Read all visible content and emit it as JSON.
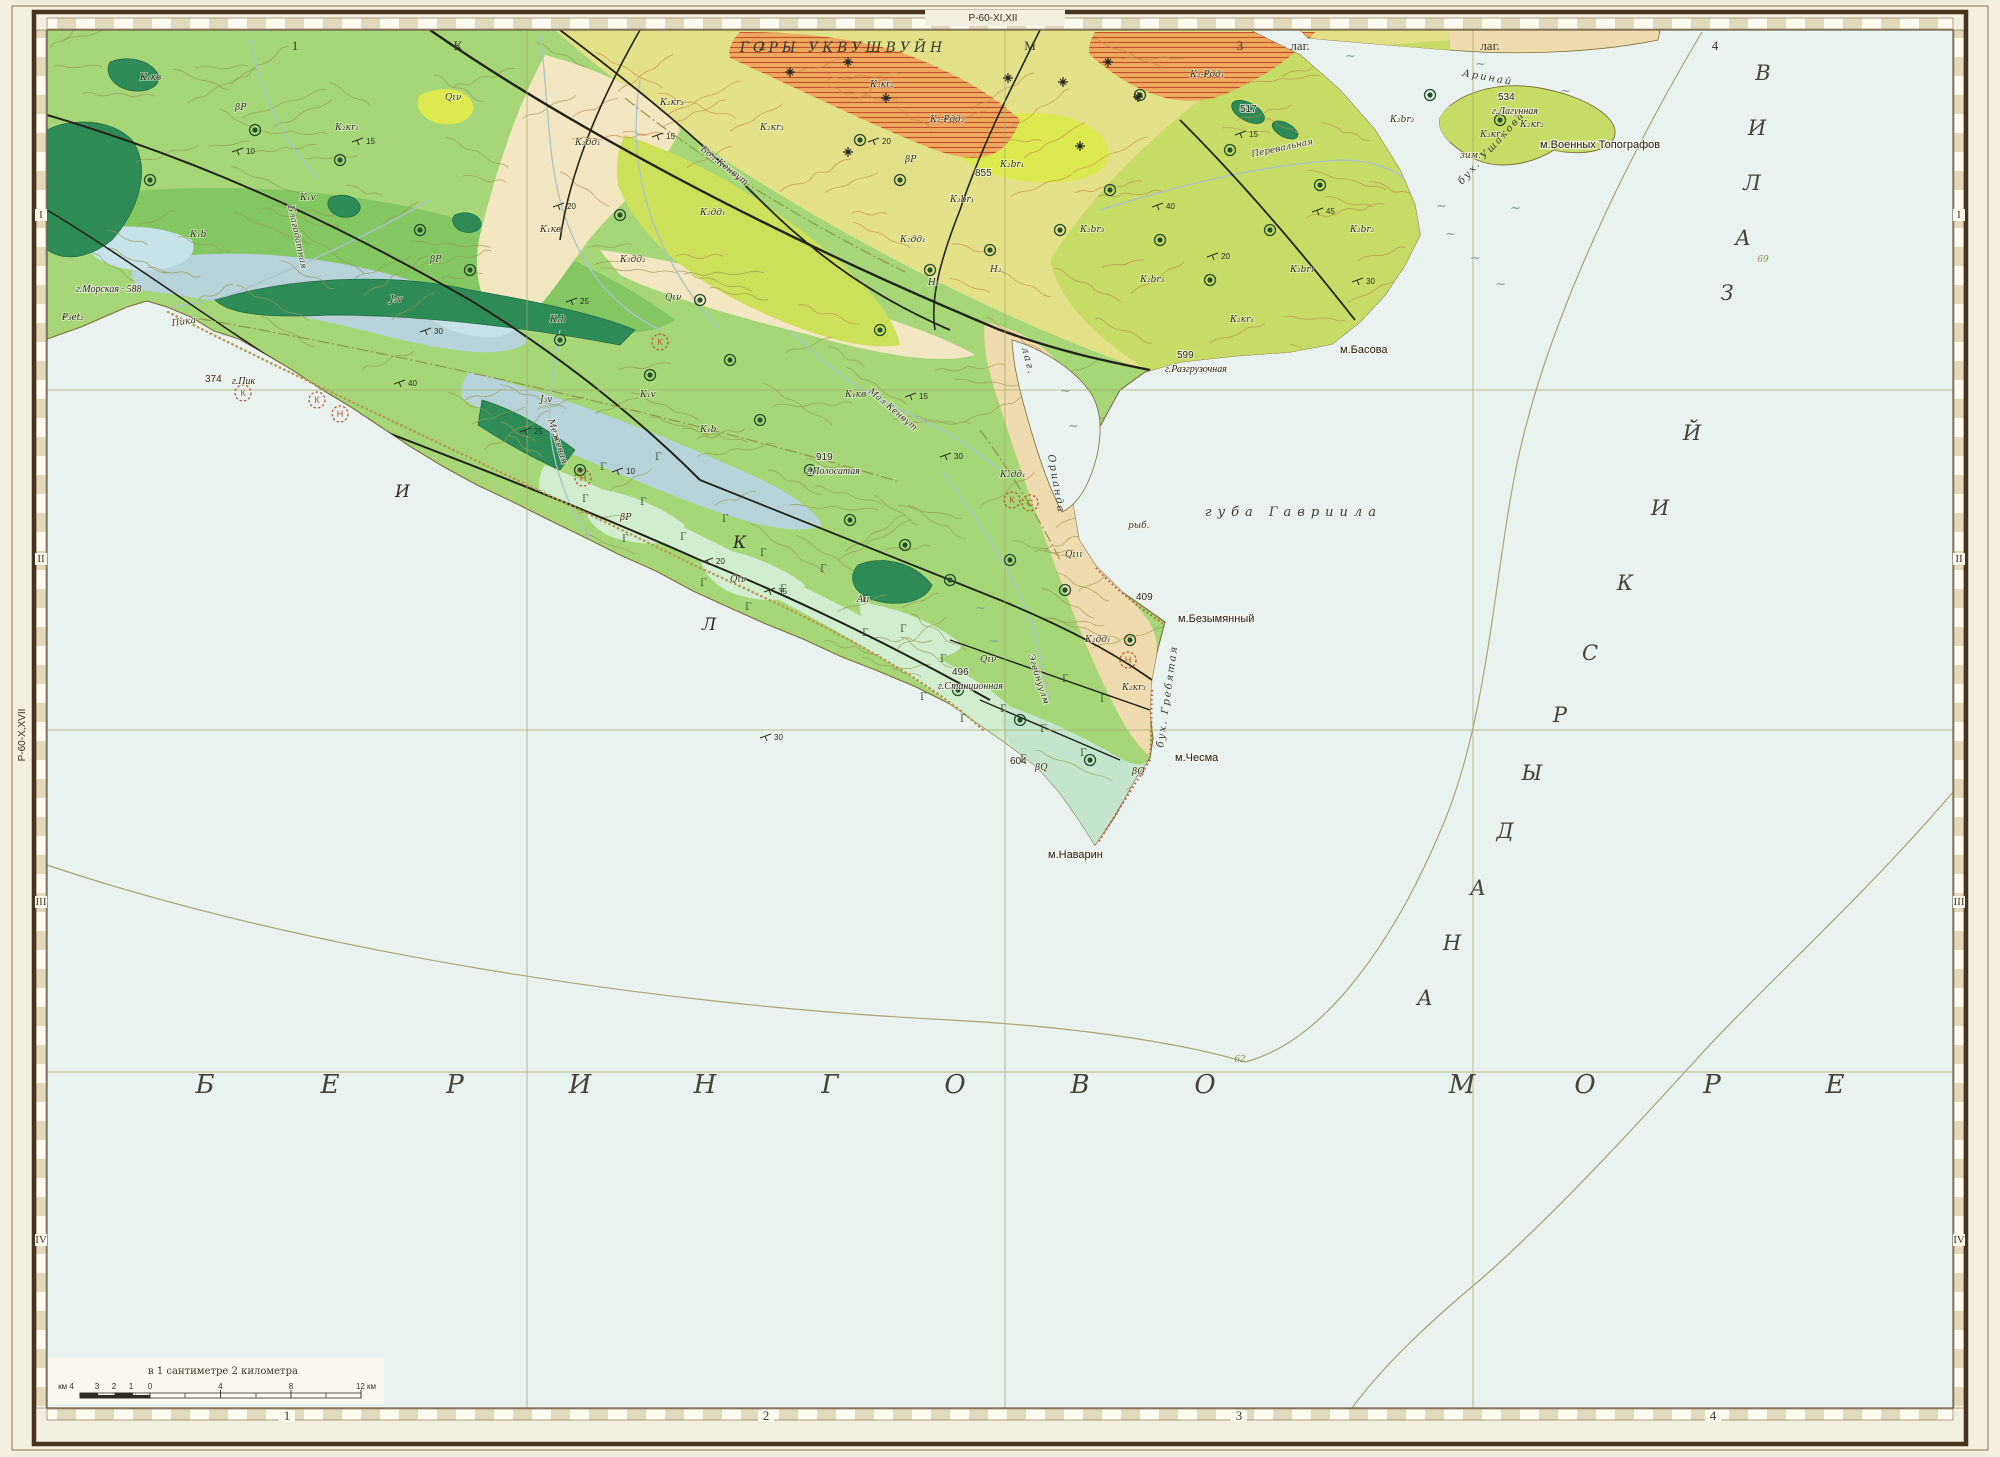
{
  "sheet": {
    "top_code": "Р-60-XI,XII",
    "left_code": "Р-60-X,XVII",
    "scale_note": "в 1 сантиметре 2 километра",
    "scale_left_numbers": [
      "км 4",
      "3",
      "2",
      "1",
      "0"
    ],
    "scale_right_numbers": [
      "4",
      "8",
      "12 км"
    ]
  },
  "palette": {
    "paper": "#f2eee0",
    "sea": "#e9f2ee",
    "frame_dark": "#46321f",
    "frame_line": "#8a7a5c",
    "grid": "#a9aa6b",
    "land": "#a6d678",
    "yellow_zone": "#e3e08a",
    "cream": "#f3e7c2",
    "tan": "#efdcae",
    "orange": "#eda95f",
    "orange_hatch": "#c2502a",
    "bright_yellow": "#dce94e",
    "bright_green_yellow": "#cce05a",
    "ne_band": "#c6dc66",
    "teal": "#2e8b57",
    "med_green": "#7cc45e",
    "blue_gray": "#b8d2da",
    "light_blue": "#c7e2e8",
    "mint": "#d2ecd0",
    "mint2": "#c5e4cd",
    "contour_olive": "#97994f",
    "contour_red": "#c08a4a",
    "fault": "#23231a",
    "coast": "#7e6f3e",
    "river": "#a9c2cc",
    "beach": "#b99a55",
    "red_fringe": "#c4553b",
    "ore": "#274e2a",
    "red_sym": "#b5552e"
  },
  "frame": {
    "top_labels": [
      {
        "t": "1",
        "x": 295
      },
      {
        "t": "К",
        "x": 458
      },
      {
        "t": "2",
        "x": 762
      },
      {
        "t": "М",
        "x": 1030
      },
      {
        "t": "3",
        "x": 1240
      },
      {
        "t": "лаг.",
        "x": 1300
      },
      {
        "t": "лаг.",
        "x": 1490
      },
      {
        "t": "4",
        "x": 1715
      }
    ],
    "range_label": {
      "t": "ГОРЫ УКВУШВУЙН",
      "x": 843,
      "y": 52
    },
    "bottom_labels": [
      {
        "t": "1",
        "x": 287
      },
      {
        "t": "2",
        "x": 766
      },
      {
        "t": "3",
        "x": 1239
      },
      {
        "t": "4",
        "x": 1713
      }
    ],
    "left_romans": [
      {
        "t": "I",
        "y": 218
      },
      {
        "t": "II",
        "y": 562
      },
      {
        "t": "III",
        "y": 905
      },
      {
        "t": "IV",
        "y": 1243
      }
    ],
    "right_romans": [
      {
        "t": "I",
        "y": 218
      },
      {
        "t": "II",
        "y": 562
      },
      {
        "t": "III",
        "y": 905
      },
      {
        "t": "IV",
        "y": 1243
      }
    ]
  },
  "map": {
    "sea_name_letters": {
      "text": "БЕРИНГОВО МОРЕ",
      "y": 1093,
      "letters": [
        [
          "Б",
          205
        ],
        [
          "Е",
          330
        ],
        [
          "Р",
          455
        ],
        [
          "И",
          580
        ],
        [
          "Н",
          705
        ],
        [
          "Г",
          830
        ],
        [
          "О",
          955
        ],
        [
          "В",
          1080
        ],
        [
          "О",
          1205
        ],
        [
          "М",
          1462
        ],
        [
          "О",
          1585
        ],
        [
          "Р",
          1712
        ],
        [
          "Е",
          1835
        ]
      ]
    },
    "gulf_name_letters": {
      "text": "АНАДЫРСКИЙ ЗАЛИВ",
      "letters": [
        [
          "А",
          1425,
          1005
        ],
        [
          "Н",
          1452,
          950
        ],
        [
          "А",
          1478,
          895
        ],
        [
          "Д",
          1505,
          838
        ],
        [
          "Ы",
          1532,
          780
        ],
        [
          "Р",
          1560,
          722
        ],
        [
          "С",
          1590,
          660
        ],
        [
          "К",
          1625,
          590
        ],
        [
          "И",
          1660,
          515
        ],
        [
          "Й",
          1692,
          440
        ],
        [
          "З",
          1727,
          300
        ],
        [
          "А",
          1743,
          245
        ],
        [
          "Л",
          1752,
          190
        ],
        [
          "И",
          1757,
          135
        ],
        [
          "В",
          1763,
          80
        ]
      ]
    },
    "depth_labels": [
      {
        "t": "62",
        "x": 1240,
        "y": 1062
      },
      {
        "t": "69",
        "x": 1763,
        "y": 262
      }
    ],
    "labels": [
      {
        "t": "губа Гавриила",
        "x": 1205,
        "y": 516,
        "c": "bay"
      },
      {
        "t": "лаг.",
        "x": 1022,
        "y": 348,
        "c": "bayr",
        "r": 76
      },
      {
        "t": "Орианда",
        "x": 1048,
        "y": 455,
        "c": "bayr",
        "r": 80
      },
      {
        "t": "бух. Гребятая",
        "x": 1163,
        "y": 748,
        "c": "bayr",
        "r": -82
      },
      {
        "t": "бух. Ушакова",
        "x": 1462,
        "y": 185,
        "c": "bayr",
        "r": -48
      },
      {
        "t": "Аринай",
        "x": 1462,
        "y": 76,
        "c": "bayr",
        "r": 10
      },
      {
        "t": "м.Наварин",
        "x": 1048,
        "y": 858,
        "c": "cape"
      },
      {
        "t": "м.Чесма",
        "x": 1175,
        "y": 761,
        "c": "cape"
      },
      {
        "t": "м.Безымянный",
        "x": 1178,
        "y": 622,
        "c": "cape"
      },
      {
        "t": "м.Басова",
        "x": 1340,
        "y": 353,
        "c": "cape"
      },
      {
        "t": "м.Военных Топографов",
        "x": 1540,
        "y": 148,
        "c": "cape"
      },
      {
        "t": "рыб.",
        "x": 1128,
        "y": 528,
        "c": "misc"
      },
      {
        "t": "зим.",
        "x": 1460,
        "y": 158,
        "c": "misc"
      },
      {
        "t": "Au",
        "x": 857,
        "y": 602,
        "c": "misc"
      },
      {
        "t": "374",
        "x": 205,
        "y": 382,
        "c": "elev"
      },
      {
        "t": "г.Пик",
        "x": 232,
        "y": 384,
        "c": "mnt"
      },
      {
        "t": "г.Морская · 588",
        "x": 76,
        "y": 292,
        "c": "mnt"
      },
      {
        "t": "919",
        "x": 816,
        "y": 460,
        "c": "elev"
      },
      {
        "t": "г.Полосатая",
        "x": 806,
        "y": 474,
        "c": "mnt"
      },
      {
        "t": "496",
        "x": 952,
        "y": 675,
        "c": "elev"
      },
      {
        "t": "г.Станционная",
        "x": 938,
        "y": 689,
        "c": "mnt"
      },
      {
        "t": "855",
        "x": 975,
        "y": 176,
        "c": "elev"
      },
      {
        "t": "604",
        "x": 1010,
        "y": 764,
        "c": "elev"
      },
      {
        "t": "409",
        "x": 1136,
        "y": 600,
        "c": "elev"
      },
      {
        "t": "517",
        "x": 1240,
        "y": 112,
        "c": "elev"
      },
      {
        "t": "534",
        "x": 1498,
        "y": 100,
        "c": "elev"
      },
      {
        "t": "г.Лагунная",
        "x": 1492,
        "y": 114,
        "c": "mnt"
      },
      {
        "t": "599",
        "x": 1177,
        "y": 358,
        "c": "elev"
      },
      {
        "t": "г.Разгрузочная",
        "x": 1165,
        "y": 372,
        "c": "mnt"
      },
      {
        "t": "Пика",
        "x": 172,
        "y": 326,
        "c": "riv",
        "r": -8
      },
      {
        "t": "Бол.Кенвут",
        "x": 700,
        "y": 150,
        "c": "riv",
        "r": 38
      },
      {
        "t": "Мал.Кенвут",
        "x": 868,
        "y": 392,
        "c": "riv",
        "r": 40
      },
      {
        "t": "Перевальная",
        "x": 1252,
        "y": 157,
        "c": "riv",
        "r": -12
      },
      {
        "t": "Межевая",
        "x": 548,
        "y": 420,
        "c": "riv",
        "r": 72
      },
      {
        "t": "Благодатная",
        "x": 288,
        "y": 206,
        "c": "riv",
        "r": 78
      },
      {
        "t": "Эгейнуулм",
        "x": 1028,
        "y": 655,
        "c": "riv",
        "r": 72
      },
      {
        "t": "И",
        "x": 395,
        "y": 497,
        "c": "gl"
      },
      {
        "t": "К",
        "x": 733,
        "y": 548,
        "c": "gl"
      },
      {
        "t": "Л",
        "x": 702,
        "y": 630,
        "c": "gl"
      },
      {
        "t": "К₁кв",
        "x": 140,
        "y": 80,
        "c": "unit"
      },
      {
        "t": "βР",
        "x": 235,
        "y": 110,
        "c": "unit"
      },
      {
        "t": "К₂кr₁",
        "x": 335,
        "y": 130,
        "c": "unit"
      },
      {
        "t": "Qιν",
        "x": 445,
        "y": 100,
        "c": "unit"
      },
      {
        "t": "К₂дд₁",
        "x": 575,
        "y": 145,
        "c": "unit"
      },
      {
        "t": "К₂кr₃",
        "x": 660,
        "y": 105,
        "c": "unit"
      },
      {
        "t": "К₂кr₃",
        "x": 760,
        "y": 130,
        "c": "unit"
      },
      {
        "t": "К₂дд₁",
        "x": 700,
        "y": 215,
        "c": "unit"
      },
      {
        "t": "К₂дд₂",
        "x": 620,
        "y": 262,
        "c": "unit"
      },
      {
        "t": "К₁кв",
        "x": 540,
        "y": 232,
        "c": "unit"
      },
      {
        "t": "К₁v",
        "x": 300,
        "y": 200,
        "c": "unit"
      },
      {
        "t": "К₁b",
        "x": 190,
        "y": 237,
        "c": "unit"
      },
      {
        "t": "J₃v",
        "x": 390,
        "y": 302,
        "c": "unit"
      },
      {
        "t": "К₁b",
        "x": 550,
        "y": 322,
        "c": "unit"
      },
      {
        "t": "К₁v",
        "x": 640,
        "y": 397,
        "c": "unit"
      },
      {
        "t": "К₁b",
        "x": 700,
        "y": 432,
        "c": "unit"
      },
      {
        "t": "J₃v",
        "x": 540,
        "y": 402,
        "c": "unit"
      },
      {
        "t": "К₁кв",
        "x": 845,
        "y": 397,
        "c": "unit"
      },
      {
        "t": "К₂дд₁",
        "x": 900,
        "y": 242,
        "c": "unit"
      },
      {
        "t": "К₂br₁",
        "x": 950,
        "y": 202,
        "c": "unit"
      },
      {
        "t": "К₂br₁",
        "x": 1000,
        "y": 167,
        "c": "unit"
      },
      {
        "t": "К₂кr₂",
        "x": 870,
        "y": 87,
        "c": "unit"
      },
      {
        "t": "К₂-₽дд₂",
        "x": 930,
        "y": 122,
        "c": "unit"
      },
      {
        "t": "К₂-₽дд₁",
        "x": 1190,
        "y": 77,
        "c": "unit"
      },
      {
        "t": "Н₁",
        "x": 928,
        "y": 285,
        "c": "unit"
      },
      {
        "t": "Н₂",
        "x": 990,
        "y": 272,
        "c": "unit"
      },
      {
        "t": "К₂br₃",
        "x": 1080,
        "y": 232,
        "c": "unit"
      },
      {
        "t": "К₂br₃",
        "x": 1140,
        "y": 282,
        "c": "unit"
      },
      {
        "t": "К₂кr₁",
        "x": 1230,
        "y": 322,
        "c": "unit"
      },
      {
        "t": "К₂br₁",
        "x": 1290,
        "y": 272,
        "c": "unit"
      },
      {
        "t": "К₂br₂",
        "x": 1350,
        "y": 232,
        "c": "unit"
      },
      {
        "t": "К₂br₂",
        "x": 1390,
        "y": 122,
        "c": "unit"
      },
      {
        "t": "К₂кr₁",
        "x": 1480,
        "y": 137,
        "c": "unit"
      },
      {
        "t": "К₂кr₂",
        "x": 1520,
        "y": 127,
        "c": "unit"
      },
      {
        "t": "К₂дд₁",
        "x": 1000,
        "y": 477,
        "c": "unit"
      },
      {
        "t": "К₂дд₁",
        "x": 1085,
        "y": 642,
        "c": "unit"
      },
      {
        "t": "К₂кr₃",
        "x": 1122,
        "y": 690,
        "c": "unit"
      },
      {
        "t": "Qιν",
        "x": 665,
        "y": 300,
        "c": "unit"
      },
      {
        "t": "Qιν",
        "x": 980,
        "y": 662,
        "c": "unit"
      },
      {
        "t": "Qιν",
        "x": 730,
        "y": 582,
        "c": "unit"
      },
      {
        "t": "Qιιι",
        "x": 1065,
        "y": 557,
        "c": "unit"
      },
      {
        "t": "βQ",
        "x": 1035,
        "y": 770,
        "c": "unit"
      },
      {
        "t": "βQ",
        "x": 1132,
        "y": 774,
        "c": "unit"
      },
      {
        "t": "βР",
        "x": 430,
        "y": 262,
        "c": "unit"
      },
      {
        "t": "βР",
        "x": 620,
        "y": 520,
        "c": "unit"
      },
      {
        "t": "βР",
        "x": 905,
        "y": 162,
        "c": "unit"
      },
      {
        "t": "₽₃еt₂",
        "x": 62,
        "y": 320,
        "c": "unit"
      }
    ],
    "gamma_symbols": [
      [
        600,
        470
      ],
      [
        640,
        505
      ],
      [
        680,
        540
      ],
      [
        722,
        522
      ],
      [
        760,
        556
      ],
      [
        700,
        586
      ],
      [
        780,
        592
      ],
      [
        820,
        572
      ],
      [
        862,
        602
      ],
      [
        900,
        632
      ],
      [
        940,
        662
      ],
      [
        862,
        636
      ],
      [
        920,
        700
      ],
      [
        1000,
        712
      ],
      [
        1040,
        732
      ],
      [
        1080,
        756
      ],
      [
        1020,
        762
      ],
      [
        960,
        722
      ],
      [
        622,
        542
      ],
      [
        582,
        502
      ],
      [
        1062,
        682
      ],
      [
        1100,
        702
      ],
      [
        655,
        460
      ],
      [
        745,
        610
      ]
    ],
    "wave_marks": [
      [
        1475,
        68
      ],
      [
        1445,
        238
      ],
      [
        1470,
        262
      ],
      [
        1495,
        288
      ],
      [
        1060,
        395
      ],
      [
        1068,
        430
      ],
      [
        975,
        612
      ],
      [
        988,
        645
      ],
      [
        1510,
        212
      ],
      [
        1436,
        210
      ],
      [
        1345,
        60
      ],
      [
        1560,
        95
      ]
    ],
    "ore_points": [
      [
        340,
        160
      ],
      [
        420,
        230
      ],
      [
        470,
        270
      ],
      [
        560,
        340
      ],
      [
        620,
        215
      ],
      [
        650,
        375
      ],
      [
        700,
        300
      ],
      [
        760,
        420
      ],
      [
        810,
        470
      ],
      [
        850,
        520
      ],
      [
        905,
        545
      ],
      [
        950,
        580
      ],
      [
        580,
        470
      ],
      [
        730,
        360
      ],
      [
        880,
        330
      ],
      [
        930,
        270
      ],
      [
        990,
        250
      ],
      [
        1060,
        230
      ],
      [
        1110,
        190
      ],
      [
        1160,
        240
      ],
      [
        1210,
        280
      ],
      [
        1270,
        230
      ],
      [
        1320,
        185
      ],
      [
        1140,
        95
      ],
      [
        1230,
        150
      ],
      [
        1430,
        95
      ],
      [
        1500,
        120
      ],
      [
        860,
        140
      ],
      [
        900,
        180
      ],
      [
        1010,
        560
      ],
      [
        1065,
        590
      ],
      [
        1130,
        640
      ],
      [
        958,
        690
      ],
      [
        1020,
        720
      ],
      [
        1090,
        760
      ],
      [
        255,
        130
      ],
      [
        150,
        180
      ]
    ],
    "red_circles": [
      [
        243,
        393,
        "К"
      ],
      [
        317,
        400,
        "К"
      ],
      [
        340,
        414,
        "Н"
      ],
      [
        583,
        478,
        "Н"
      ],
      [
        660,
        342,
        "К"
      ],
      [
        1012,
        500,
        "К"
      ],
      [
        1030,
        503,
        "С"
      ],
      [
        1128,
        660,
        "Н"
      ]
    ],
    "crosses": [
      [
        790,
        72
      ],
      [
        848,
        62
      ],
      [
        886,
        98
      ],
      [
        848,
        152
      ],
      [
        1008,
        78
      ],
      [
        1063,
        82
      ],
      [
        1108,
        62
      ],
      [
        1138,
        97
      ],
      [
        1080,
        146
      ]
    ],
    "dips": [
      [
        232,
        152,
        "10"
      ],
      [
        352,
        142,
        "15"
      ],
      [
        553,
        207,
        "20"
      ],
      [
        652,
        137,
        "15"
      ],
      [
        566,
        302,
        "25"
      ],
      [
        420,
        332,
        "30"
      ],
      [
        394,
        384,
        "40"
      ],
      [
        520,
        432,
        "25"
      ],
      [
        612,
        472,
        "10"
      ],
      [
        702,
        562,
        "20"
      ],
      [
        764,
        592,
        "35"
      ],
      [
        905,
        397,
        "15"
      ],
      [
        1152,
        207,
        "40"
      ],
      [
        1207,
        257,
        "20"
      ],
      [
        1312,
        212,
        "45"
      ],
      [
        1352,
        282,
        "30"
      ],
      [
        868,
        142,
        "20"
      ],
      [
        940,
        457,
        "30"
      ],
      [
        1235,
        135,
        "15"
      ],
      [
        760,
        738,
        "30"
      ]
    ],
    "squiggles": {
      "count": 175,
      "seed": 11
    }
  }
}
